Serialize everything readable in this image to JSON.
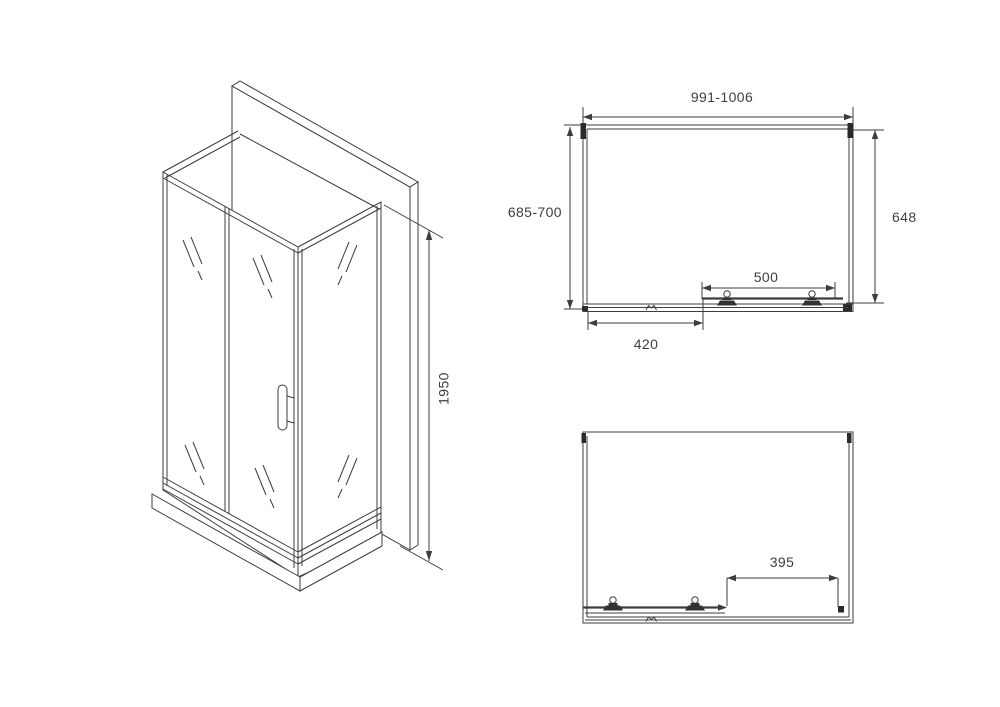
{
  "canvas": {
    "width": 1000,
    "height": 707,
    "background": "#ffffff"
  },
  "drawing": {
    "subject": "shower-enclosure-technical-drawing",
    "line_color": "#3d3d3d",
    "solid_fill": "#2a2a2a",
    "text_color": "#3f3f3f",
    "views": {
      "isometric": "isometric-view",
      "top_plan": "top-plan-view",
      "bottom_plan": "bottom-plan-view"
    },
    "dimensions": {
      "height": "1950",
      "width_range": "991-1006",
      "depth_range": "685-700",
      "side_panel": "648",
      "door_width": "500",
      "opening_left": "420",
      "opening_right": "395"
    }
  }
}
